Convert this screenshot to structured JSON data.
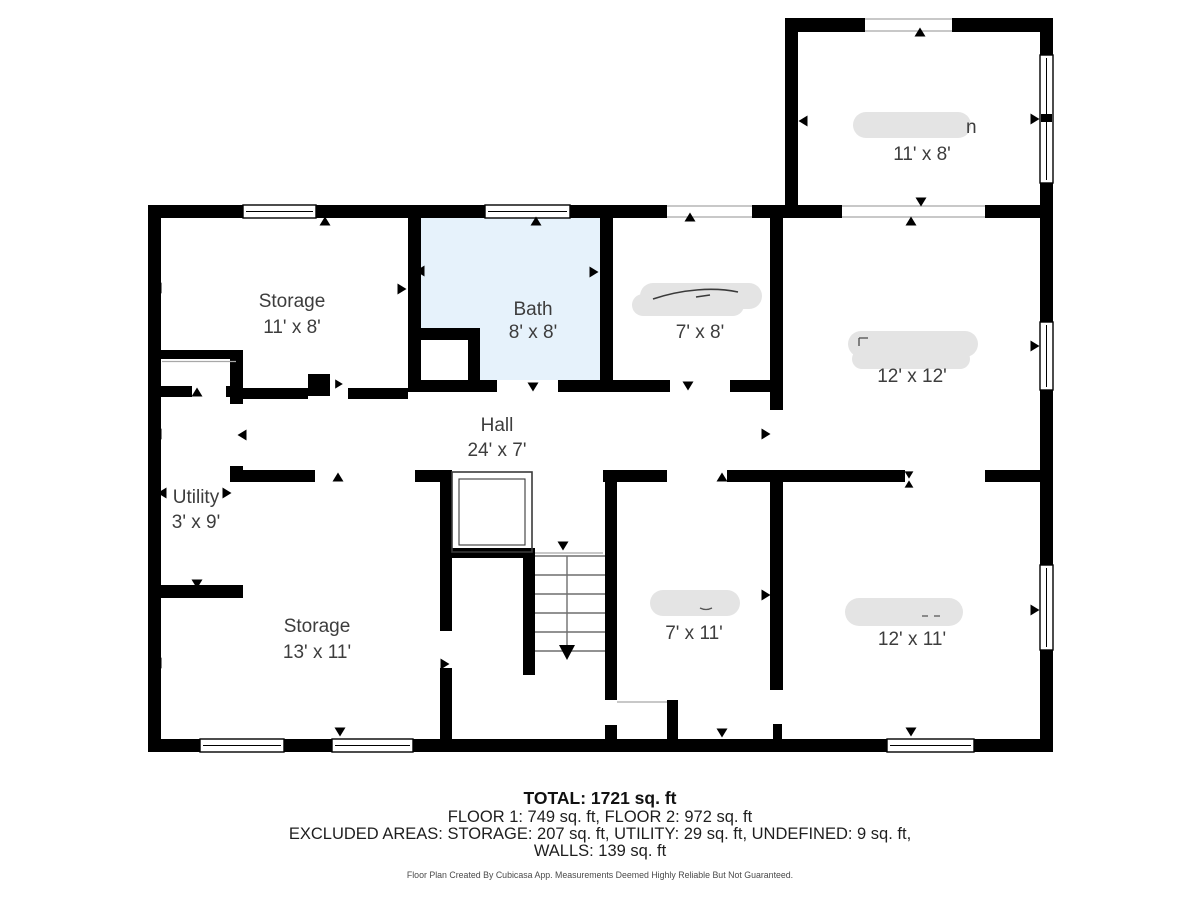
{
  "floor_plan": {
    "colors": {
      "wall": "#000000",
      "bath_fill": "#e6f2fb",
      "redaction_fill": "#e4e4e4",
      "label_text": "#3d3d3d"
    },
    "rooms": [
      {
        "id": "storage-top",
        "name": "Storage",
        "dims": "11' x 8'",
        "name_redacted": false
      },
      {
        "id": "bath",
        "name": "Bath",
        "dims": "8' x 8'",
        "name_redacted": false
      },
      {
        "id": "room-7x8",
        "name": "",
        "dims": "7' x 8'",
        "name_redacted": true
      },
      {
        "id": "room-12x12",
        "name": "",
        "dims": "12' x 12'",
        "name_redacted": true
      },
      {
        "id": "hall",
        "name": "Hall",
        "dims": "24' x 7'",
        "name_redacted": false
      },
      {
        "id": "utility",
        "name": "Utility",
        "dims": "3' x 9'",
        "name_redacted": false
      },
      {
        "id": "storage-bottom",
        "name": "Storage",
        "dims": "13' x 11'",
        "name_redacted": false
      },
      {
        "id": "room-7x11",
        "name": "",
        "dims": "7' x 11'",
        "name_redacted": true
      },
      {
        "id": "room-12x11",
        "name": "",
        "dims": "12' x 11'",
        "name_redacted": true
      },
      {
        "id": "room-top-right",
        "name": "n",
        "dims": "11' x 8'",
        "name_redacted": true
      }
    ]
  },
  "summary": {
    "total": "TOTAL: 1721 sq. ft",
    "floors": "FLOOR 1: 749 sq. ft, FLOOR 2: 972 sq. ft",
    "excluded": "EXCLUDED AREAS: STORAGE: 207 sq. ft, UTILITY: 29 sq. ft, UNDEFINED: 9 sq. ft,",
    "walls": "WALLS: 139 sq. ft"
  },
  "watermark": "Floor Plan Created By Cubicasa App. Measurements Deemed Highly Reliable But Not Guaranteed."
}
